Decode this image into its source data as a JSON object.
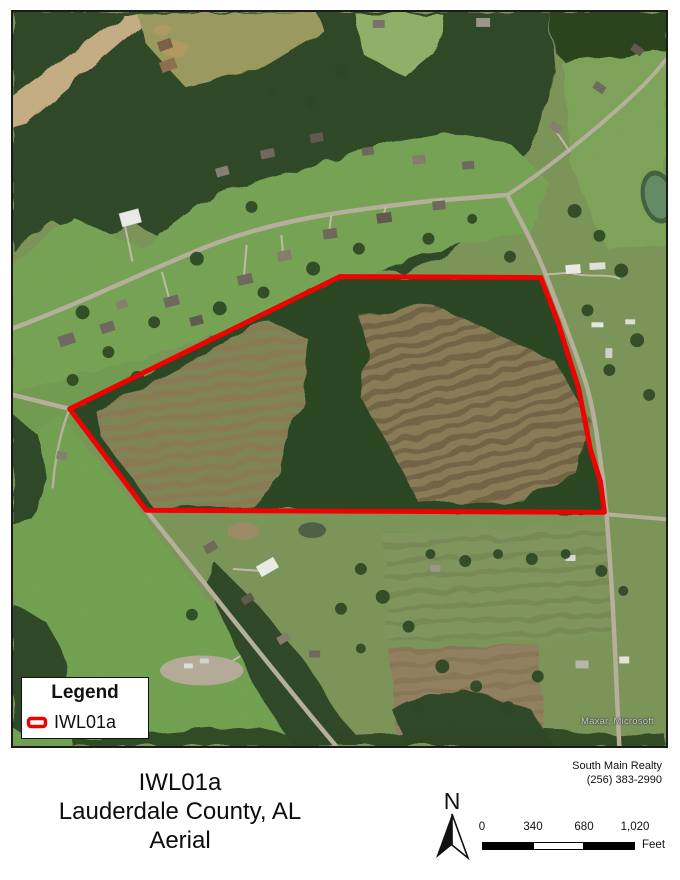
{
  "map": {
    "attribution": "Maxar, Microsoft",
    "outline_color": "#ee0202",
    "legend": {
      "title": "Legend",
      "items": [
        {
          "label": "IWL01a"
        }
      ]
    }
  },
  "footer": {
    "title_lines": [
      "IWL01a",
      "Lauderdale County, AL",
      "Aerial"
    ],
    "contact_lines": [
      "South Main Realty",
      "(256) 383-2990"
    ],
    "north_label": "N",
    "scale_bar": {
      "ticks": [
        "0",
        "340",
        "680",
        "1,020"
      ],
      "unit_label": "Feet"
    }
  }
}
